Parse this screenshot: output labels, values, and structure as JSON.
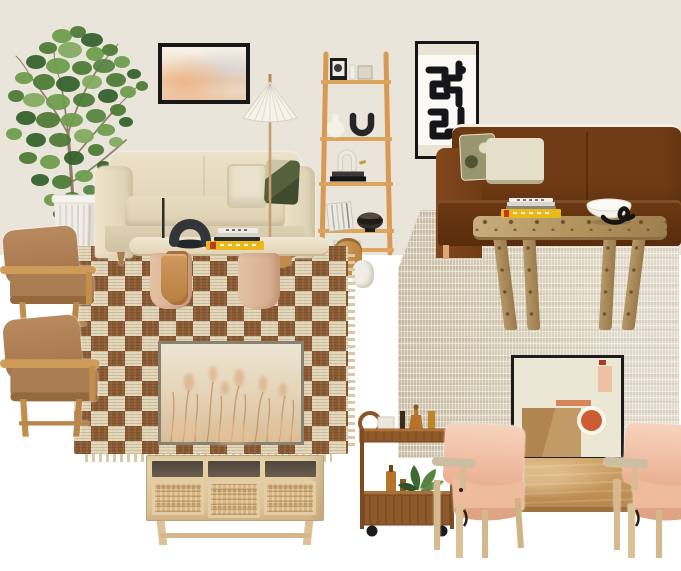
{
  "meta": {
    "description": "Interior design moodboard collage with two living room vignettes",
    "scene_left": "Cream sofa living room with checkerboard rug",
    "scene_right": "Rust brown velvet sofa living room with jute rug"
  },
  "palette": {
    "wall": "#e9e5da",
    "white": "#ffffff",
    "rug_brown": "#8a5a33",
    "rug_cream": "#e3d7ba",
    "jute": "#d5ccb8",
    "sofa_cream": "#e6dcc3",
    "sofa_brown": "#713c15",
    "oak": "#d79a54",
    "camel": "#ad8158",
    "blush": "#f0c2a8",
    "burl": "#b3955f",
    "travertine": "#ece1c8",
    "terracotta": "#cd5c31",
    "tan_square": "#b1854f",
    "book_yellow": "#e9b91c",
    "leaf_green": "#5b8a3c",
    "cart_wood": "#8a5527",
    "black": "#161616"
  },
  "items": [
    {
      "id": "wall-backdrop",
      "label": "Beige wall backdrop"
    },
    {
      "id": "potted-tree",
      "label": "Faux tree in white ribbed planter"
    },
    {
      "id": "sunset-art",
      "label": "Framed sunset photograph"
    },
    {
      "id": "ladder-shelf",
      "label": "Oak ladder bookshelf with decor objects"
    },
    {
      "id": "wood-vase",
      "label": "Wooden vase"
    },
    {
      "id": "white-vase",
      "label": "White ceramic vase"
    },
    {
      "id": "checkered-rug",
      "label": "Brown and cream checkerboard rug"
    },
    {
      "id": "cream-sofa",
      "label": "Cream upholstered sofa with pillows"
    },
    {
      "id": "floor-lamp",
      "label": "Pleated cone shade floor lamp"
    },
    {
      "id": "wood-stool",
      "label": "Round wood stool"
    },
    {
      "id": "travertine-table",
      "label": "Travertine oval coffee table"
    },
    {
      "id": "candelabra",
      "label": "Black sculptural U candelabra"
    },
    {
      "id": "books-left",
      "label": "Stack of books with yellow spine"
    },
    {
      "id": "magazine-holder",
      "label": "Tan leather magazine holder"
    },
    {
      "id": "armchair-top",
      "label": "Oak armchair with camel cushions"
    },
    {
      "id": "armchair-bottom",
      "label": "Oak armchair with camel cushions"
    },
    {
      "id": "grass-art",
      "label": "Framed dried grass field print"
    },
    {
      "id": "media-console",
      "label": "Whitewashed cane-door media console"
    },
    {
      "id": "abstract-art",
      "label": "Black abstract line art print"
    },
    {
      "id": "jute-rug",
      "label": "Natural woven jute rug"
    },
    {
      "id": "brown-sofa",
      "label": "Rust brown velvet sofa with pillows"
    },
    {
      "id": "burl-table",
      "label": "Burl wood coffee table"
    },
    {
      "id": "books-right",
      "label": "Stack of books with yellow spine"
    },
    {
      "id": "bowl-sculpture",
      "label": "White bowl with black wire sculpture"
    },
    {
      "id": "geometric-art",
      "label": "Framed geometric abstract art"
    },
    {
      "id": "wood-plank",
      "label": "Light oak sideboard panel"
    },
    {
      "id": "bar-cart",
      "label": "Rattan bar cart with bottles and plant"
    },
    {
      "id": "pink-chair-left",
      "label": "Blush leather sling lounge chair"
    },
    {
      "id": "pink-chair-right",
      "label": "Blush leather sling lounge chair"
    }
  ]
}
